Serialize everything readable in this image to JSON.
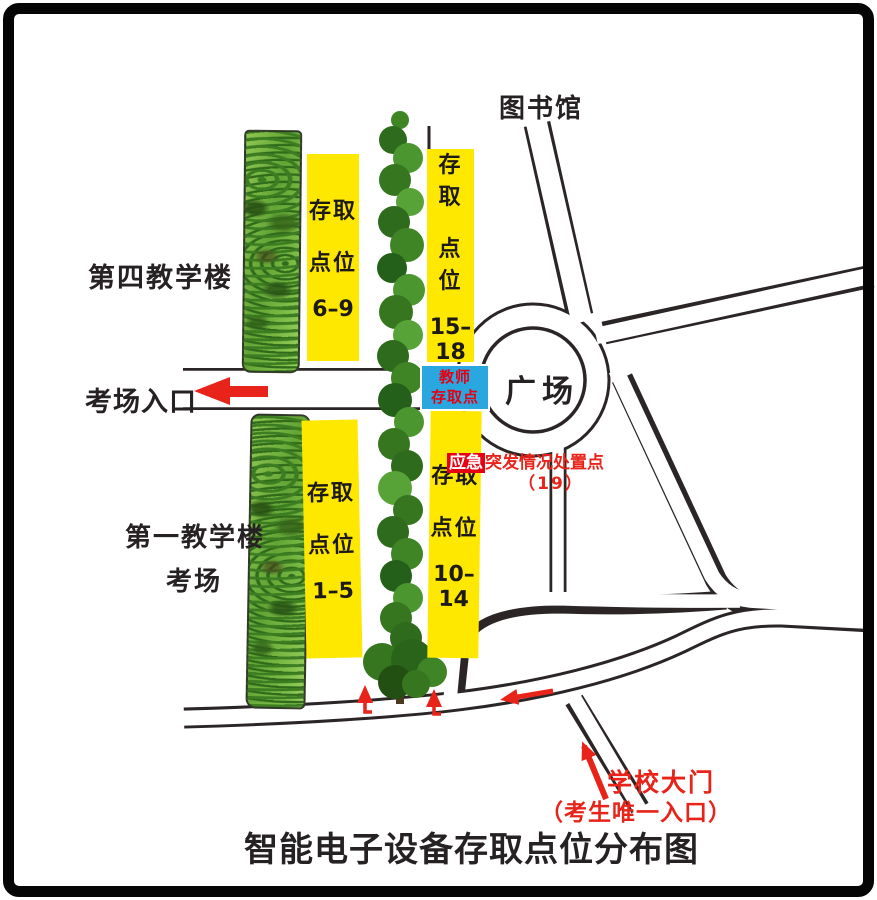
{
  "title": "智能电子设备存取点位分布图",
  "labels": {
    "library": "图书馆",
    "plaza": "广场",
    "building4": "第四教学楼",
    "exam_entrance": "考场入口",
    "building1": "第一教学楼",
    "exam_room": "考场",
    "school_gate": "学校大门",
    "gate_note": "（考生唯一入口）"
  },
  "storage_points": [
    {
      "lines": [
        "存取",
        "点位",
        "6–9"
      ]
    },
    {
      "lines": [
        "存取",
        "点位",
        "15–18"
      ]
    },
    {
      "lines": [
        "存取",
        "点位",
        "1–5"
      ]
    },
    {
      "lines": [
        "存取",
        "点位",
        "10–14"
      ]
    }
  ],
  "teacher_point": {
    "lines": [
      "教师",
      "存取点"
    ]
  },
  "emergency": {
    "highlight": "应急",
    "rest": "突发情况处置点",
    "number": "（19）"
  },
  "colors": {
    "storage_box": "#ffe800",
    "teacher_box": "#2aa7df",
    "accent_red": "#e8241a",
    "emergency_red": "#e60012",
    "road_line": "#2b2526",
    "vegetation_green": "#63a535"
  }
}
